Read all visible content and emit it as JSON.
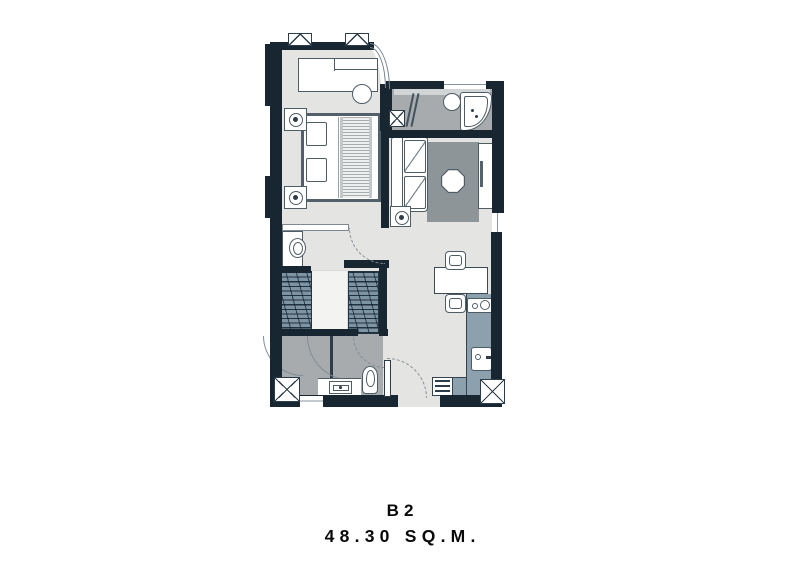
{
  "unit_label": {
    "name": "B2",
    "area": "48.30 SQ.M."
  },
  "colors": {
    "wall": "#182632",
    "line": "#4e5c66",
    "line-dark": "#2c3c48",
    "floor": "#e4e5e3",
    "floor-bright": "#f3f3f1",
    "bath-floor": "#a7abad",
    "rug": "#8d9599",
    "counter": "#8ca0ae",
    "wardrobe": "#7d94a5",
    "arc": "#828d95",
    "text": "#0a0a0a",
    "background": "#ffffff"
  }
}
